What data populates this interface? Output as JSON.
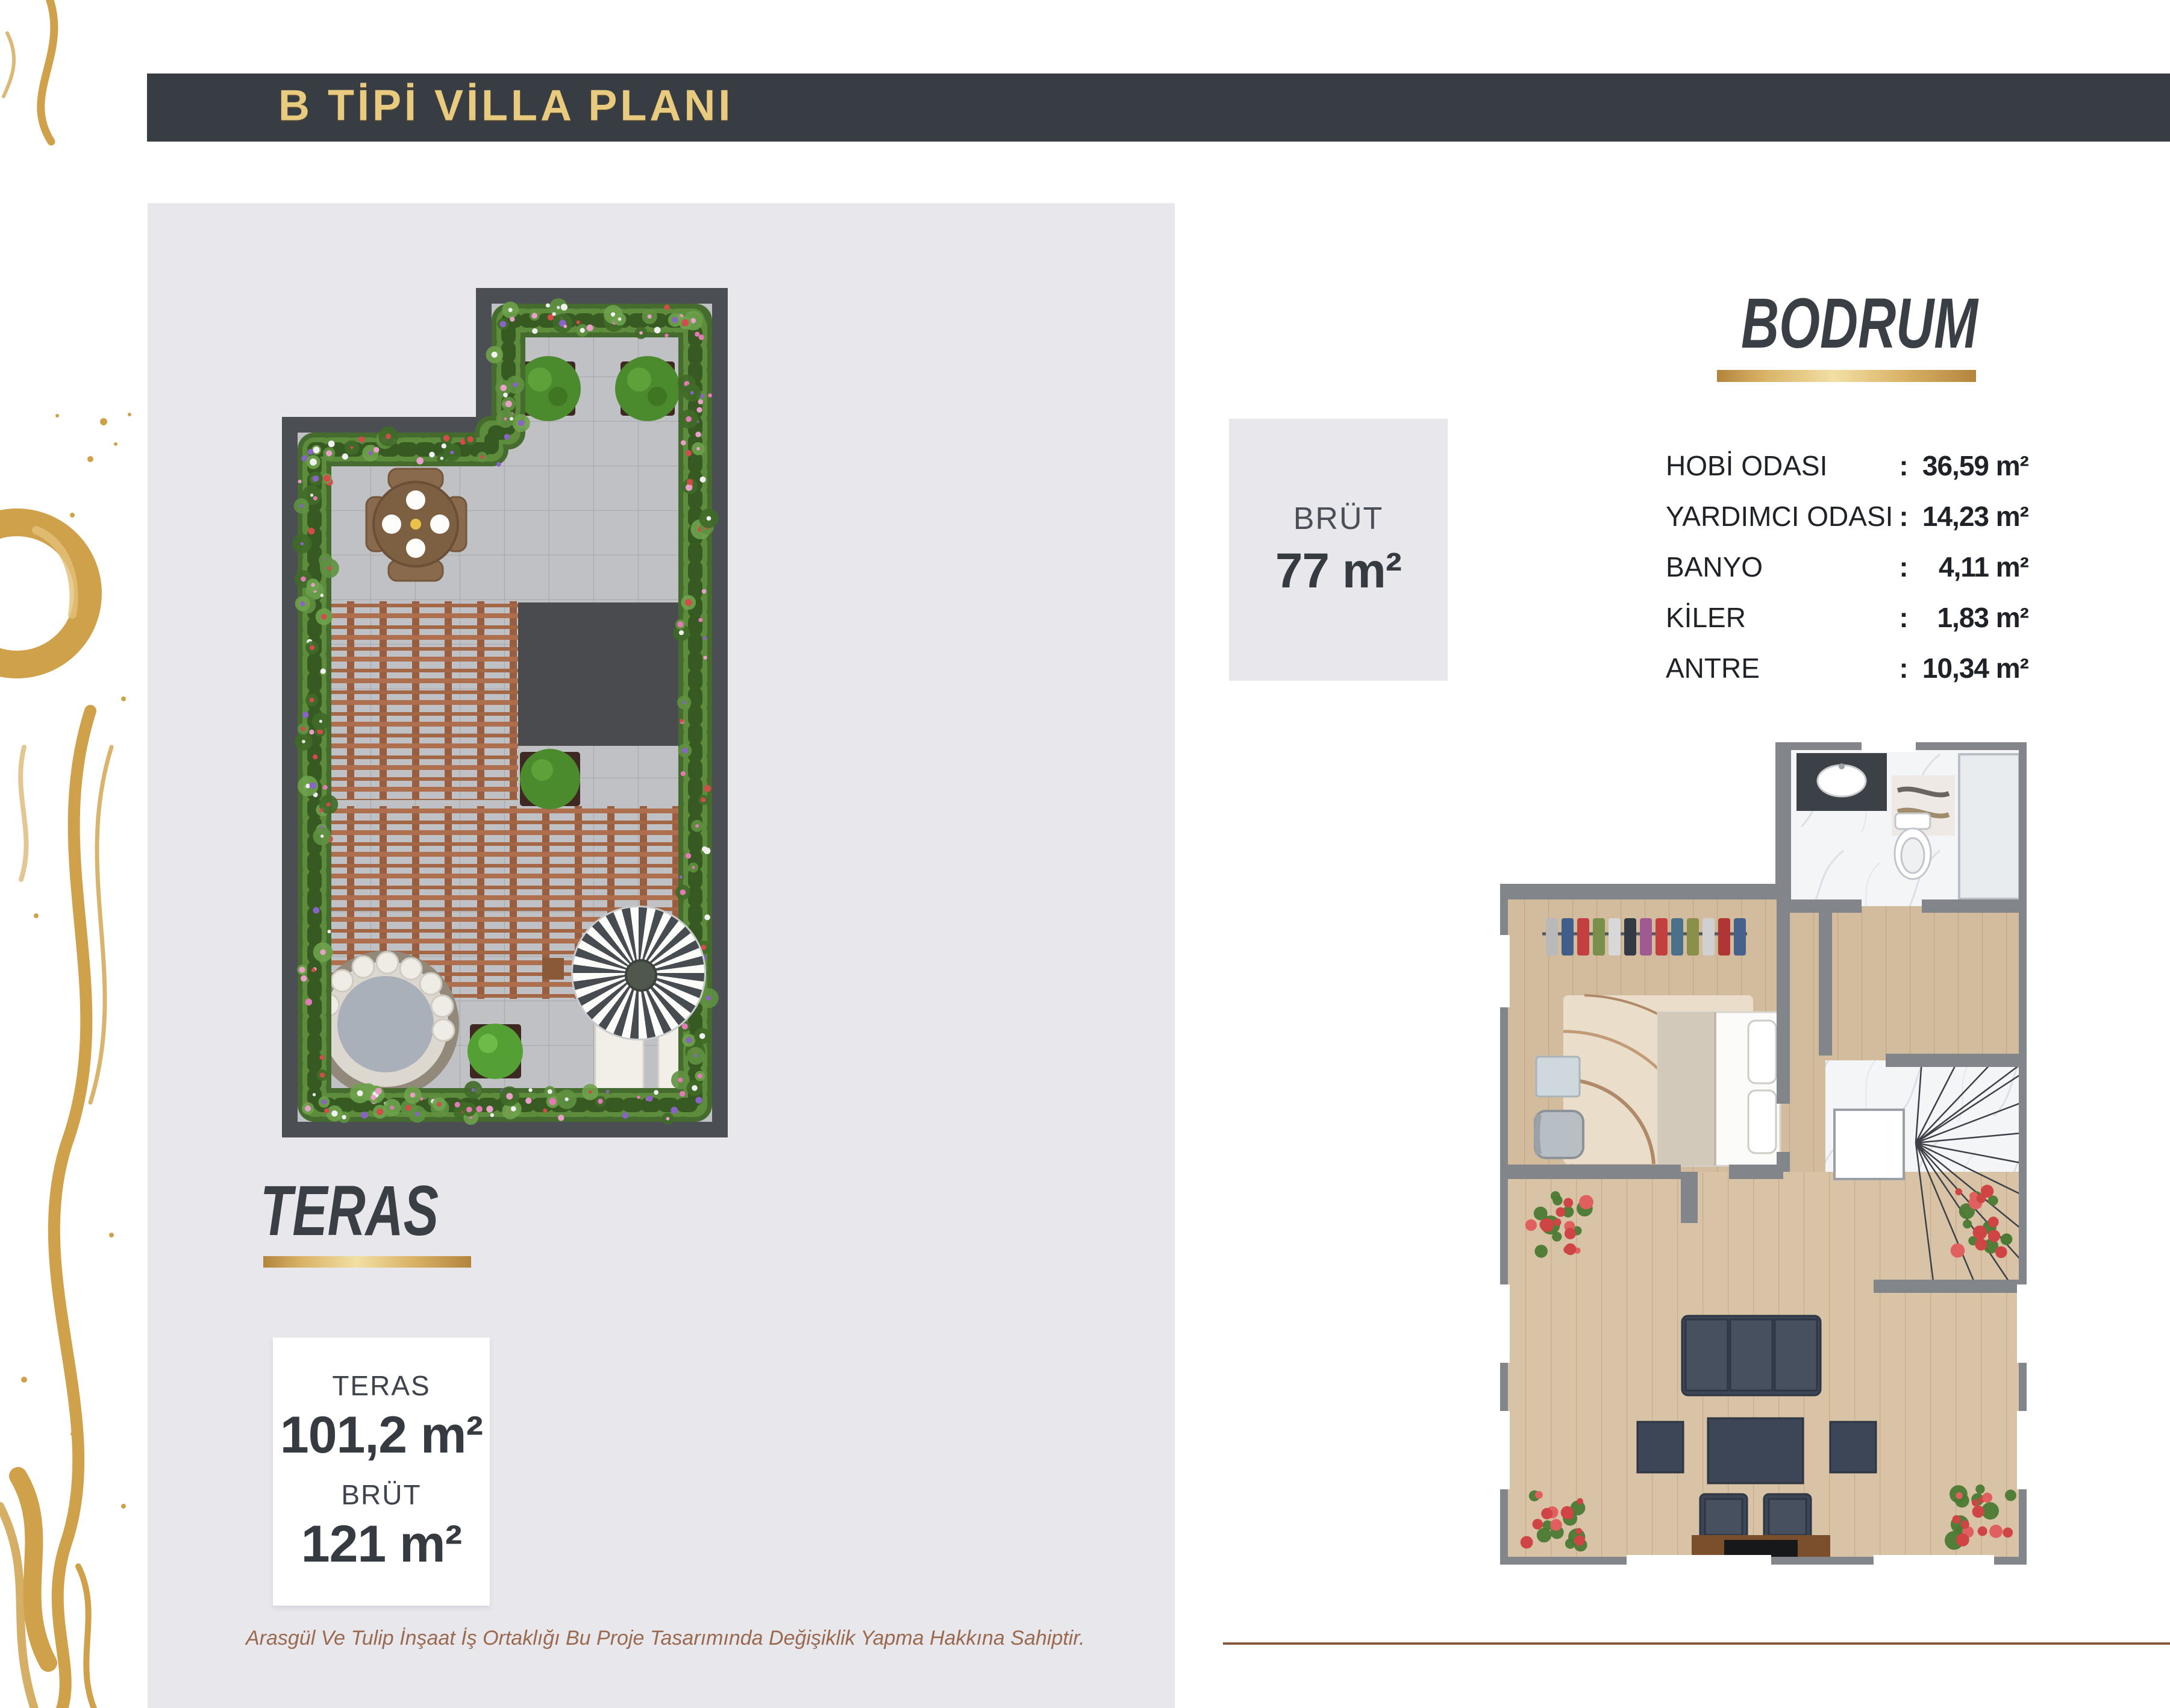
{
  "header": {
    "title": "B TİPİ VİLLA PLANI"
  },
  "teras": {
    "title": "TERAS",
    "info_box": {
      "area_label": "TERAS",
      "area_value": "101,2 m²",
      "gross_label": "BRÜT",
      "gross_value": "121 m²"
    }
  },
  "bodrum": {
    "title": "BODRUM",
    "gross_box": {
      "label": "BRÜT",
      "value": "77 m²"
    },
    "rooms": [
      {
        "name": "HOBİ ODASI",
        "sep": ":",
        "area": "36,59 m²"
      },
      {
        "name": "YARDIMCI ODASI",
        "sep": ":",
        "area": "14,23 m²"
      },
      {
        "name": "BANYO",
        "sep": ":",
        "area": "4,11 m²"
      },
      {
        "name": "KİLER",
        "sep": ":",
        "area": "1,83 m²"
      },
      {
        "name": "ANTRE",
        "sep": ":",
        "area": "10,34 m²"
      }
    ]
  },
  "footer": {
    "disclaimer": "Arasgül Ve Tulip İnşaat İş Ortaklığı Bu Proje Tasarımında Değişiklik Yapma Hakkına Sahiptir."
  },
  "colors": {
    "gold": "#d9b266",
    "header_bg": "#383c43",
    "panel_bg": "#e8e8ec",
    "title_text": "#3a3e45",
    "footer_text": "#9a6950"
  }
}
